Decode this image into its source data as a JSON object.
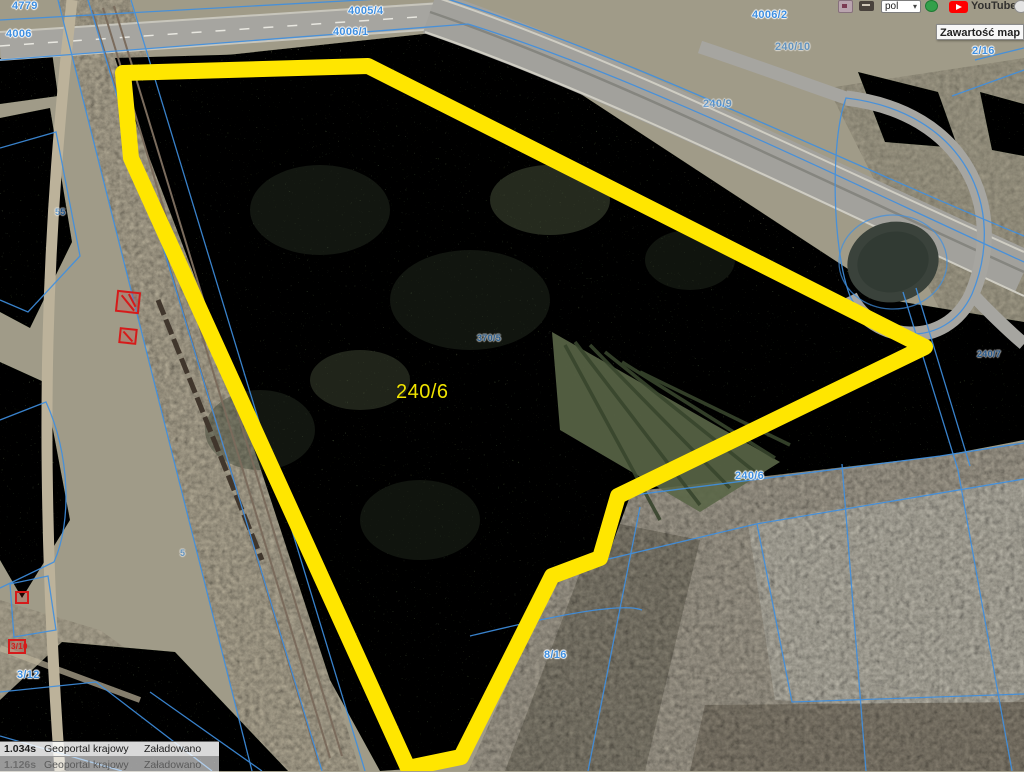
{
  "browser": {
    "language_select": "pol",
    "youtube_label": "YouTube",
    "icons": {
      "select_chevron": "▾"
    }
  },
  "tooltip": {
    "text": "Zawartość map"
  },
  "map": {
    "highlight": {
      "label": "240/6"
    },
    "labels": [
      {
        "text": "4779"
      },
      {
        "text": "4006"
      },
      {
        "text": "4005/4"
      },
      {
        "text": "4006/1"
      },
      {
        "text": "4006/2"
      },
      {
        "text": "240/10"
      },
      {
        "text": "2/16"
      },
      {
        "text": "240/9"
      },
      {
        "text": "370/5"
      },
      {
        "text": "240/6"
      },
      {
        "text": "8/16"
      },
      {
        "text": "3/12"
      },
      {
        "text": "55"
      },
      {
        "text": "5"
      },
      {
        "text": "240/7"
      },
      {
        "text": "3/10"
      }
    ],
    "colors": {
      "parcel-yellow": "#ffe600",
      "label-yellow": "#f0e300",
      "cadastral-blue": "#3f8fe0",
      "marker-red": "#d61a1a"
    }
  },
  "status_panel": {
    "rows": [
      {
        "time": "1.034s",
        "source": "Geoportal krajowy",
        "status": "Załadowano"
      },
      {
        "time": "1.126s",
        "source": "Geoportal krajowy",
        "status": "Załadowano"
      }
    ]
  }
}
